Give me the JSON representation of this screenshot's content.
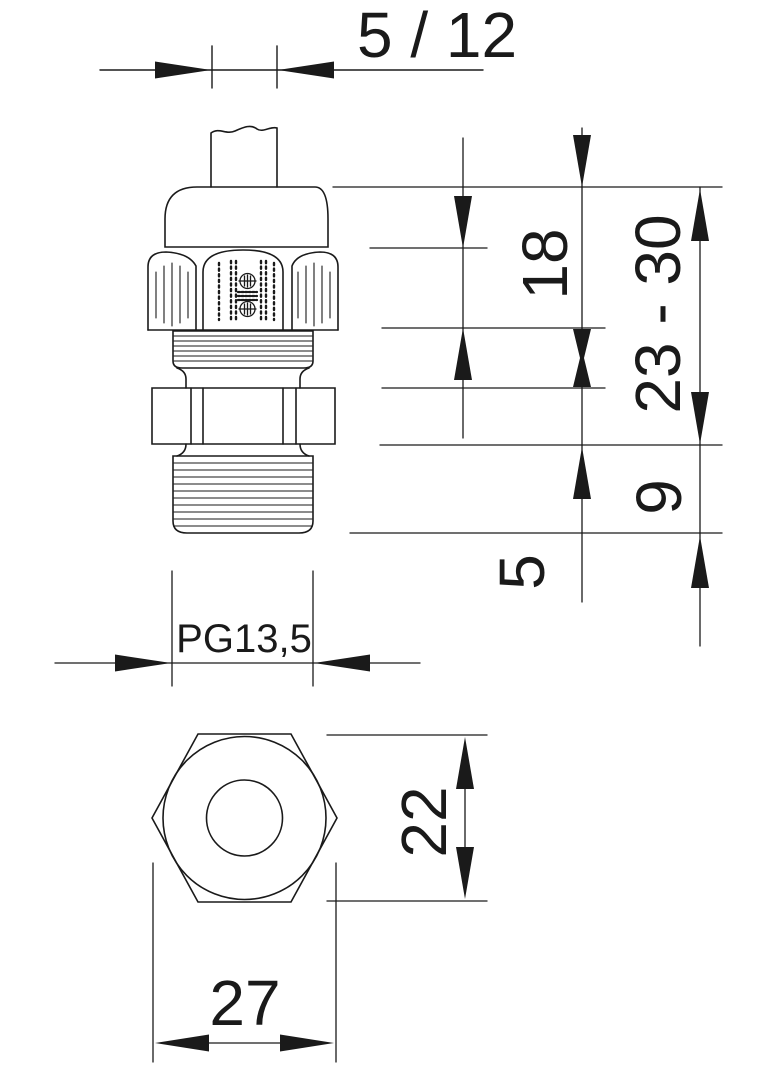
{
  "drawing": {
    "type": "technical-dimension-drawing",
    "subject": "cable-gland",
    "colors": {
      "line": "#1a1a1a",
      "background": "#ffffff"
    },
    "dimensions": {
      "clamp_range": "5 / 12",
      "cap_height": "18",
      "overall_height": "23 - 30",
      "thread_length": "9",
      "travel": "5",
      "thread_size": "PG13,5",
      "across_flats": "22",
      "across_corners": "27"
    }
  }
}
